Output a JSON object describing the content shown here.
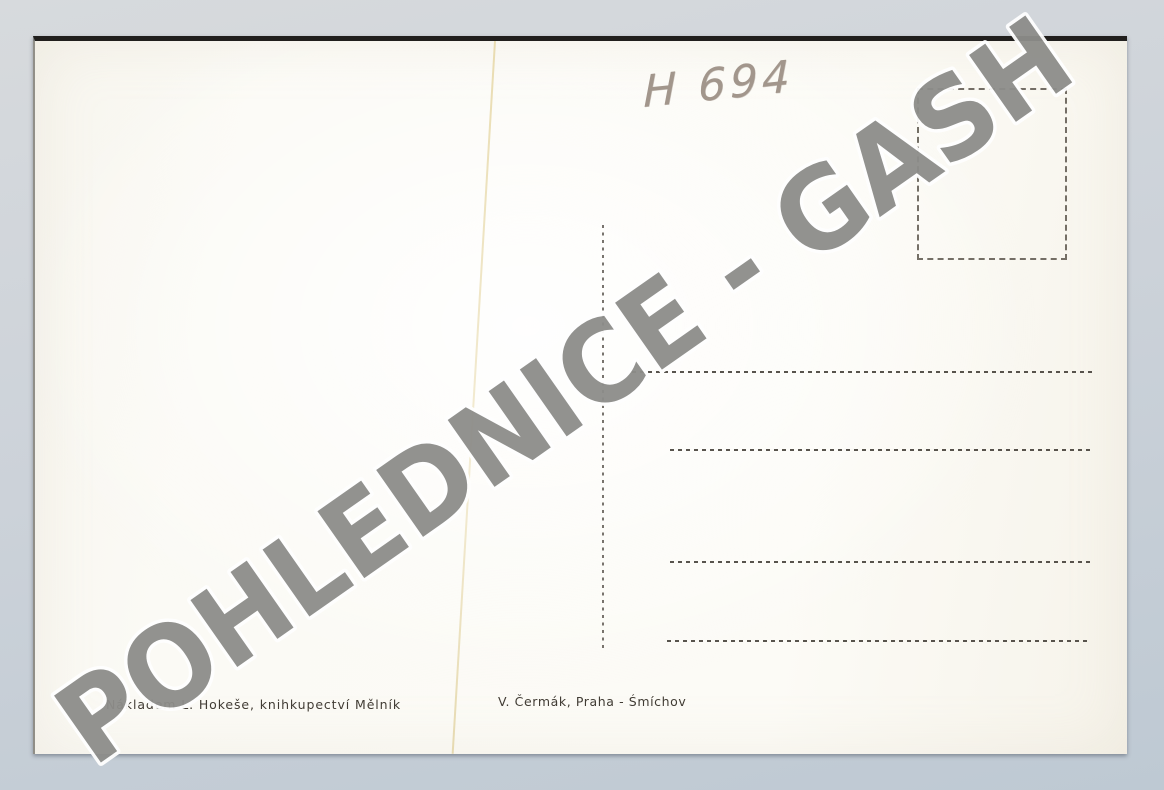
{
  "postcard": {
    "handwritten_note": "H 694",
    "publisher_line": "Nákladem L. Hokeše, knihkupectví Mělník",
    "printer_line": "V. Čermák, Praha - Śmíchov",
    "address_line_count": 4
  },
  "watermark": {
    "text": "POHLEDNICE - GASH",
    "color": "#8d8d8a"
  },
  "colors": {
    "photo_background": "#ccd2d9",
    "card_background": "#fbfaf5",
    "card_top_edge": "#211f1d",
    "printed_ink": "#46413a",
    "pencil": "#a2968c",
    "crease": "#e6d7a5"
  }
}
